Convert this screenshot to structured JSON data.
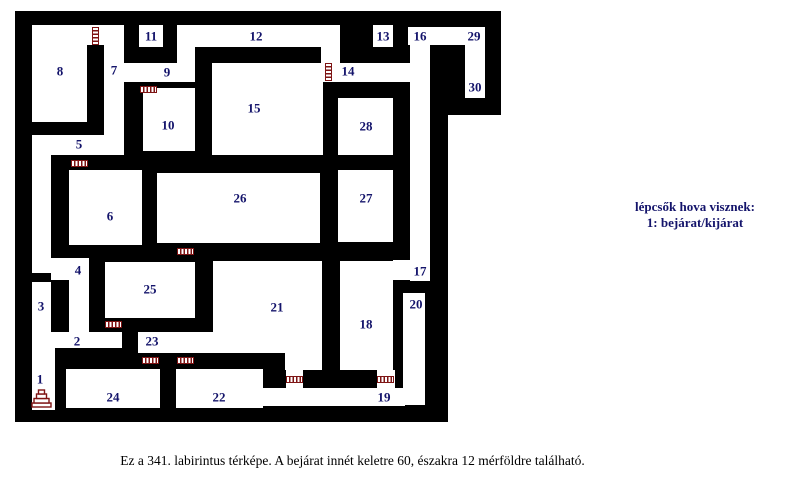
{
  "title": "labyrinth-map-341",
  "colors": {
    "wall": "#000000",
    "room": "#ffffff",
    "label": "#14146b",
    "door": "#7e1414",
    "background": "#ffffff"
  },
  "legend": {
    "line1": "lépcsők hova visznek:",
    "line2": "1: bejárat/kijárat"
  },
  "caption": "Ez a 341. labirintus térképe. A bejárat innét keletre 60, északra 12 mérföldre található.",
  "maze": {
    "wall_blocks": [
      {
        "x": 15,
        "y": 11,
        "w": 433,
        "h": 411
      },
      {
        "x": 448,
        "y": 11,
        "w": 53,
        "h": 104
      }
    ],
    "rooms": [
      {
        "x": 32,
        "y": 25,
        "w": 92,
        "h": 20
      },
      {
        "x": 32,
        "y": 25,
        "w": 55,
        "h": 97
      },
      {
        "x": 104,
        "y": 25,
        "w": 20,
        "h": 130
      },
      {
        "x": 124,
        "y": 63,
        "w": 71,
        "h": 19
      },
      {
        "x": 32,
        "y": 135,
        "w": 75,
        "h": 20
      },
      {
        "x": 32,
        "y": 135,
        "w": 19,
        "h": 138
      },
      {
        "x": 32,
        "y": 282,
        "w": 19,
        "h": 50
      },
      {
        "x": 32,
        "y": 332,
        "w": 90,
        "h": 16
      },
      {
        "x": 32,
        "y": 348,
        "w": 23,
        "h": 62
      },
      {
        "x": 51,
        "y": 258,
        "w": 38,
        "h": 22
      },
      {
        "x": 69,
        "y": 258,
        "w": 20,
        "h": 74
      },
      {
        "x": 69,
        "y": 170,
        "w": 73,
        "h": 75
      },
      {
        "x": 143,
        "y": 88,
        "w": 52,
        "h": 63
      },
      {
        "x": 139,
        "y": 25,
        "w": 24,
        "h": 22
      },
      {
        "x": 177,
        "y": 25,
        "w": 163,
        "h": 22
      },
      {
        "x": 177,
        "y": 47,
        "w": 18,
        "h": 16
      },
      {
        "x": 321,
        "y": 47,
        "w": 19,
        "h": 16
      },
      {
        "x": 321,
        "y": 63,
        "w": 109,
        "h": 19
      },
      {
        "x": 212,
        "y": 63,
        "w": 111,
        "h": 92
      },
      {
        "x": 373,
        "y": 25,
        "w": 20,
        "h": 22
      },
      {
        "x": 408,
        "y": 27,
        "w": 77,
        "h": 18
      },
      {
        "x": 465,
        "y": 27,
        "w": 20,
        "h": 71
      },
      {
        "x": 410,
        "y": 45,
        "w": 20,
        "h": 236
      },
      {
        "x": 393,
        "y": 260,
        "w": 19,
        "h": 20
      },
      {
        "x": 403,
        "y": 293,
        "w": 22,
        "h": 112
      },
      {
        "x": 338,
        "y": 98,
        "w": 55,
        "h": 57
      },
      {
        "x": 338,
        "y": 170,
        "w": 55,
        "h": 72
      },
      {
        "x": 157,
        "y": 173,
        "w": 163,
        "h": 70
      },
      {
        "x": 105,
        "y": 262,
        "w": 90,
        "h": 56
      },
      {
        "x": 138,
        "y": 332,
        "w": 93,
        "h": 21
      },
      {
        "x": 195,
        "y": 332,
        "w": 26,
        "h": 21
      },
      {
        "x": 213,
        "y": 261,
        "w": 109,
        "h": 92
      },
      {
        "x": 340,
        "y": 261,
        "w": 53,
        "h": 109
      },
      {
        "x": 176,
        "y": 369,
        "w": 87,
        "h": 39
      },
      {
        "x": 176,
        "y": 388,
        "w": 229,
        "h": 18
      },
      {
        "x": 285,
        "y": 353,
        "w": 37,
        "h": 17
      },
      {
        "x": 286,
        "y": 369,
        "w": 17,
        "h": 21
      },
      {
        "x": 377,
        "y": 370,
        "w": 18,
        "h": 20
      },
      {
        "x": 66,
        "y": 369,
        "w": 94,
        "h": 39
      }
    ],
    "doors": [
      {
        "o": "v",
        "x": 92,
        "y": 27
      },
      {
        "o": "h",
        "x": 140,
        "y": 86
      },
      {
        "o": "h",
        "x": 71,
        "y": 160
      },
      {
        "o": "v",
        "x": 325,
        "y": 63
      },
      {
        "o": "h",
        "x": 177,
        "y": 248
      },
      {
        "o": "h",
        "x": 105,
        "y": 321
      },
      {
        "o": "h",
        "x": 142,
        "y": 357
      },
      {
        "o": "h",
        "x": 177,
        "y": 357
      },
      {
        "o": "h",
        "x": 286,
        "y": 376
      },
      {
        "o": "h",
        "x": 377,
        "y": 376
      }
    ],
    "room_labels": [
      {
        "n": "1",
        "x": 40,
        "y": 379
      },
      {
        "n": "2",
        "x": 77,
        "y": 341
      },
      {
        "n": "3",
        "x": 41,
        "y": 306
      },
      {
        "n": "4",
        "x": 78,
        "y": 270
      },
      {
        "n": "5",
        "x": 79,
        "y": 144
      },
      {
        "n": "6",
        "x": 110,
        "y": 216
      },
      {
        "n": "7",
        "x": 114,
        "y": 70
      },
      {
        "n": "8",
        "x": 60,
        "y": 71
      },
      {
        "n": "9",
        "x": 167,
        "y": 72
      },
      {
        "n": "10",
        "x": 168,
        "y": 125
      },
      {
        "n": "11",
        "x": 151,
        "y": 36
      },
      {
        "n": "12",
        "x": 256,
        "y": 36
      },
      {
        "n": "13",
        "x": 383,
        "y": 36
      },
      {
        "n": "14",
        "x": 348,
        "y": 71
      },
      {
        "n": "15",
        "x": 254,
        "y": 108
      },
      {
        "n": "16",
        "x": 420,
        "y": 36
      },
      {
        "n": "17",
        "x": 420,
        "y": 271
      },
      {
        "n": "18",
        "x": 366,
        "y": 324
      },
      {
        "n": "19",
        "x": 384,
        "y": 397
      },
      {
        "n": "20",
        "x": 416,
        "y": 304
      },
      {
        "n": "21",
        "x": 277,
        "y": 307
      },
      {
        "n": "22",
        "x": 219,
        "y": 397
      },
      {
        "n": "23",
        "x": 152,
        "y": 341
      },
      {
        "n": "24",
        "x": 113,
        "y": 397
      },
      {
        "n": "25",
        "x": 150,
        "y": 289
      },
      {
        "n": "26",
        "x": 240,
        "y": 198
      },
      {
        "n": "27",
        "x": 366,
        "y": 198
      },
      {
        "n": "28",
        "x": 366,
        "y": 126
      },
      {
        "n": "29",
        "x": 474,
        "y": 36
      },
      {
        "n": "30",
        "x": 475,
        "y": 87
      }
    ],
    "stairs_icon": {
      "x": 31,
      "y": 387,
      "w": 21,
      "h": 21
    }
  }
}
